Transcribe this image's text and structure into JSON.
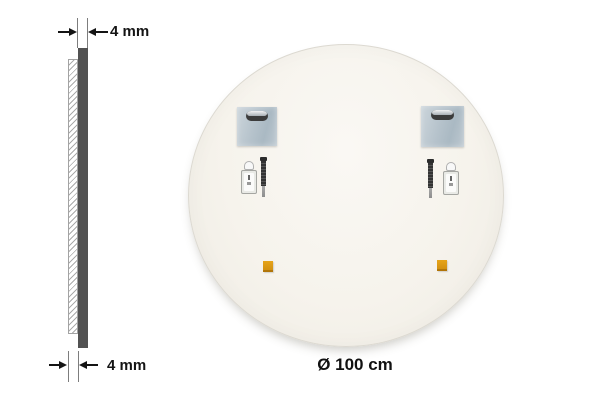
{
  "side_view": {
    "top_dimension": {
      "label": "4 mm"
    },
    "bottom_dimension": {
      "label": "4 mm"
    },
    "colors": {
      "glass_bar": "#525252",
      "hatch_line": "#ababab",
      "annotation": "#141414"
    }
  },
  "mirror_back": {
    "diameter_label": "Ø 100 cm",
    "fill_color": "#f7f4ee",
    "hardware": {
      "mounting_plate_icon": "metal-hanging-plate-with-keyhole-slot",
      "screw_icon": "dark-threaded-screw",
      "bottle_icon": "small-adhesive-bottle",
      "pad_icon": "orange-adhesive-pad",
      "plate_color": "#b7c4cd",
      "pad_color": "#dc9512",
      "counts": {
        "mounting_plates": 2,
        "screws": 2,
        "adhesive_bottles": 2,
        "adhesive_pads": 2
      }
    }
  }
}
